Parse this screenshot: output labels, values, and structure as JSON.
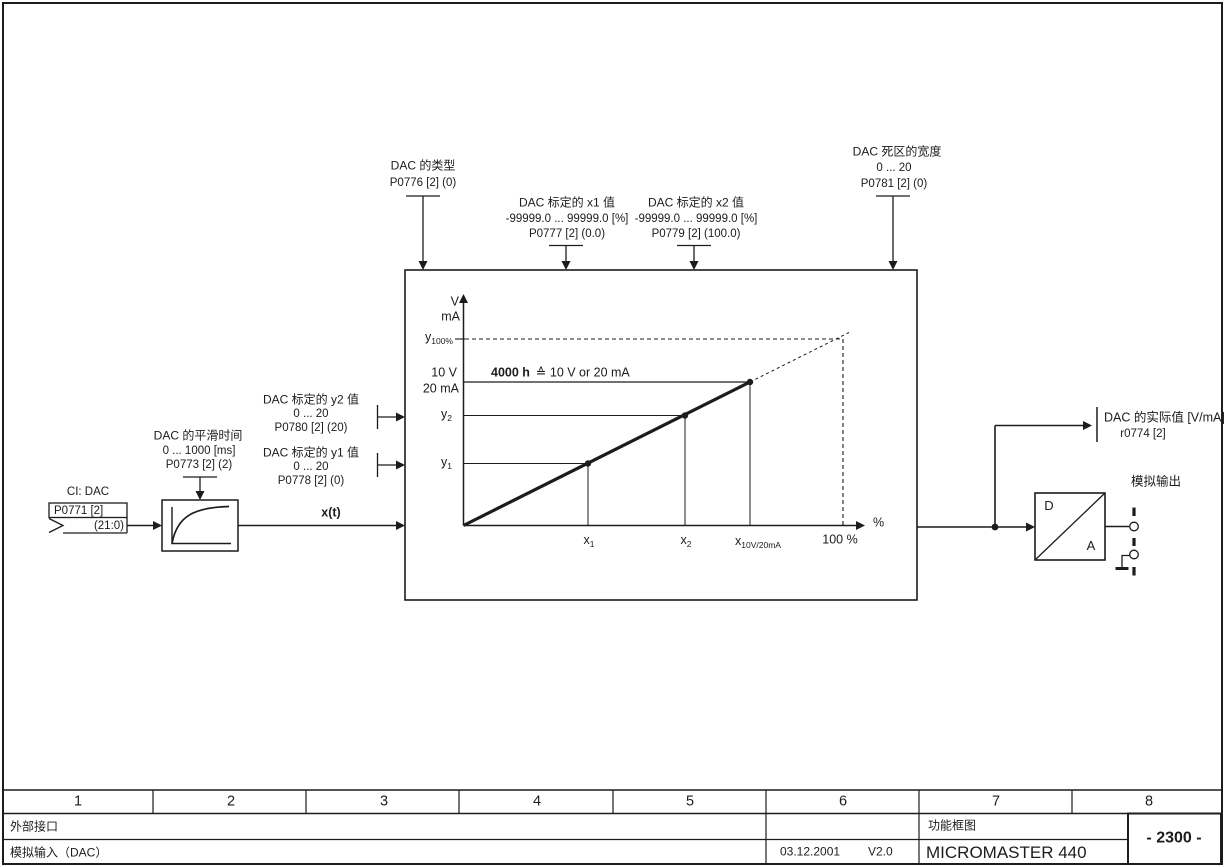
{
  "params": {
    "dac_type": {
      "title": "DAC 的类型",
      "param": "P0776 [2] (0)"
    },
    "x1": {
      "title": "DAC 标定的 x1 值",
      "range": "-99999.0 ... 99999.0  [%]",
      "param": "P0777 [2] (0.0)"
    },
    "x2": {
      "title": "DAC 标定的 x2 值",
      "range": "-99999.0 ... 99999.0  [%]",
      "param": "P0779 [2] (100.0)"
    },
    "deadband": {
      "title": "DAC 死区的宽度",
      "range": "0 ... 20",
      "param": "P0781 [2] (0)"
    },
    "smoothing": {
      "title": "DAC 的平滑时间",
      "range": "0 ... 1000  [ms]",
      "param": "P0773 [2] (2)"
    },
    "y2": {
      "title": "DAC 标定的 y2 值",
      "range": "0 ... 20",
      "param": "P0780 [2] (20)"
    },
    "y1": {
      "title": "DAC 标定的 y1 值",
      "range": "0 ... 20",
      "param": "P0778 [2] (0)"
    }
  },
  "input": {
    "label": "CI: DAC",
    "param": "P0771 [2]",
    "bits": "(21:0)"
  },
  "wire": {
    "xt": "x(t)"
  },
  "graph": {
    "unit_v": "V",
    "unit_ma": "mA",
    "y100_base": "y",
    "y100_sub": "100%",
    "ref_v": "10 V",
    "ref_ma": "20 mA",
    "note_bold": "4000 h",
    "note_rest": "≙ 10 V or 20 mA",
    "y2_base": "y",
    "y2_sub": "2",
    "y1_base": "y",
    "y1_sub": "1",
    "x1_base": "x",
    "x1_sub": "1",
    "x2_base": "x",
    "x2_sub": "2",
    "xref_base": "x",
    "xref_sub": "10V/20mA",
    "x100": "100 %",
    "pct": "%"
  },
  "output": {
    "actual_title": "DAC 的实际值 [V/mA]",
    "actual_param": "r0774 [2]",
    "analog_label": "模拟输出",
    "d": "D",
    "a": "A"
  },
  "titleblock": {
    "cols": [
      "1",
      "2",
      "3",
      "4",
      "5",
      "6",
      "7",
      "8"
    ],
    "interface": "外部接口",
    "sheet_title": "模拟输入（DAC）",
    "date": "03.12.2001",
    "version": "V2.0",
    "doc_type": "功能框图",
    "product": "MICROMASTER 440",
    "page_no": "- 2300 -"
  }
}
